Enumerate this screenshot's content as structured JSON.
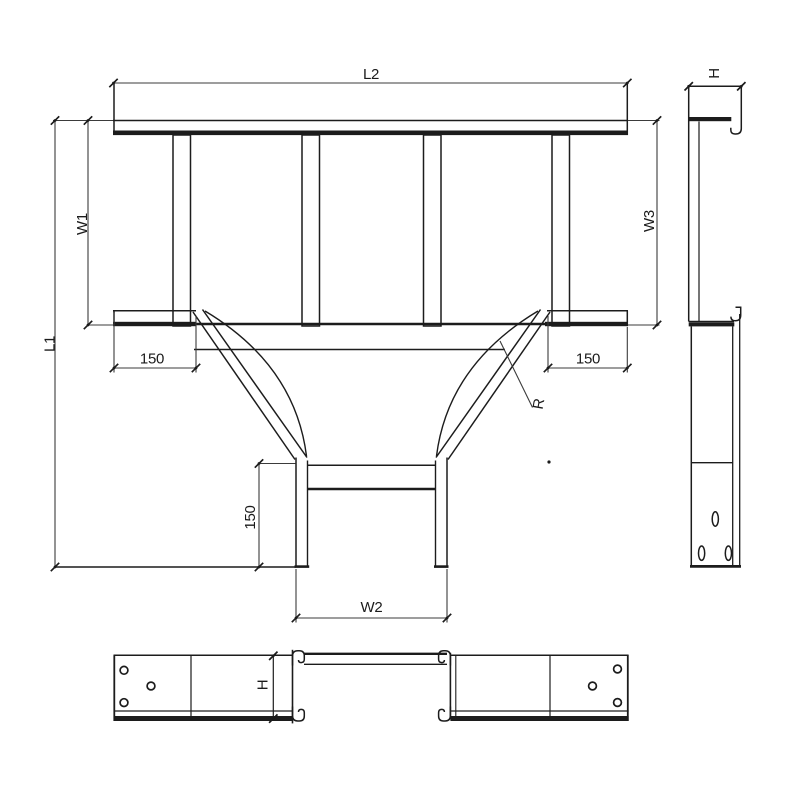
{
  "drawing": {
    "type": "technical-drawing",
    "subject": "cable-tray-equal-tee",
    "colors": {
      "line": "#1c1c1c",
      "dim_line": "#3b3b3b",
      "background": "#ffffff"
    },
    "labels": {
      "l2": "L2",
      "w1": "W1",
      "w3": "W3",
      "l1": "L1",
      "w2": "W2",
      "len_left": "150",
      "len_right": "150",
      "len_branch": "150",
      "radius": "R",
      "height_side": "H",
      "height_front": "H"
    }
  }
}
